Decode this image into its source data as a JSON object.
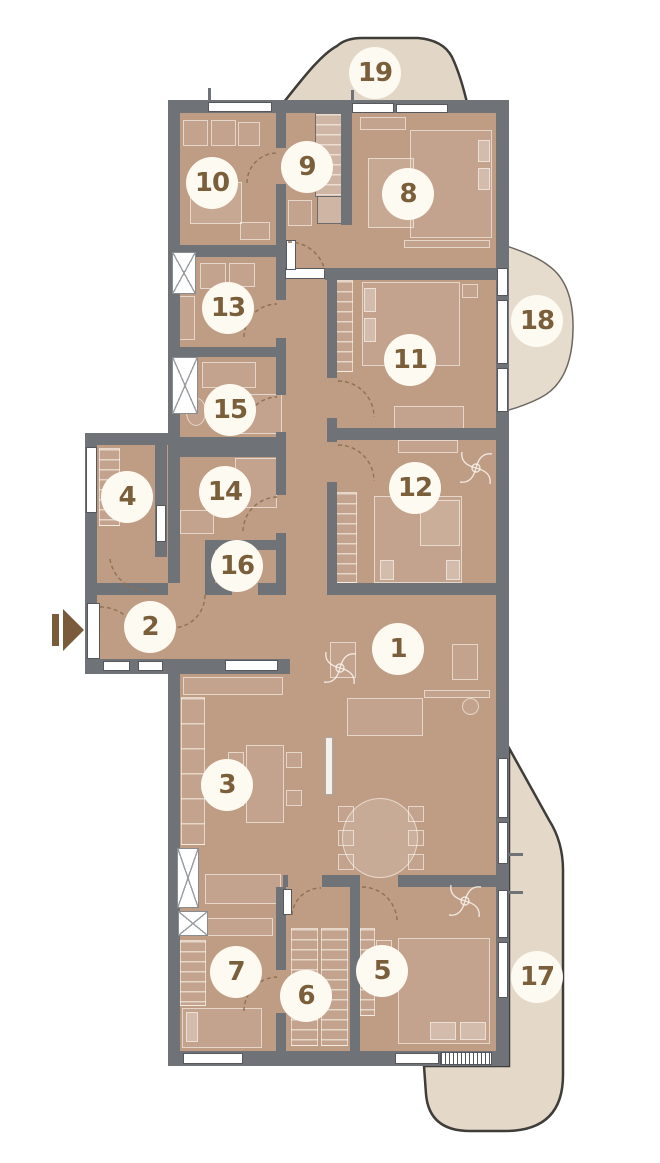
{
  "rooms": [
    {
      "label": "1"
    },
    {
      "label": "2"
    },
    {
      "label": "3"
    },
    {
      "label": "4"
    },
    {
      "label": "5"
    },
    {
      "label": "6"
    },
    {
      "label": "7"
    },
    {
      "label": "8"
    },
    {
      "label": "9"
    },
    {
      "label": "10"
    },
    {
      "label": "11"
    },
    {
      "label": "12"
    },
    {
      "label": "13"
    },
    {
      "label": "14"
    },
    {
      "label": "15"
    },
    {
      "label": "16"
    },
    {
      "label": "17"
    },
    {
      "label": "18"
    },
    {
      "label": "19"
    }
  ],
  "icons": {
    "entry": "entry-direction-arrow",
    "shaft": "ventilation-shaft-x",
    "fan": "ceiling-fan"
  },
  "colors": {
    "room_fill": "#bf9d85",
    "balcony_fill": "#e2d6c7",
    "wall": "#6f7378",
    "circle_bg": "#fdfaf2",
    "number": "#7b5f3a",
    "furniture_line": "rgba(253,248,241,0.6)",
    "door_arc": "#8f7050",
    "arrow": "#7a5b3b",
    "balcony_outline": "#3f3d39",
    "window_line": "#55585c"
  }
}
